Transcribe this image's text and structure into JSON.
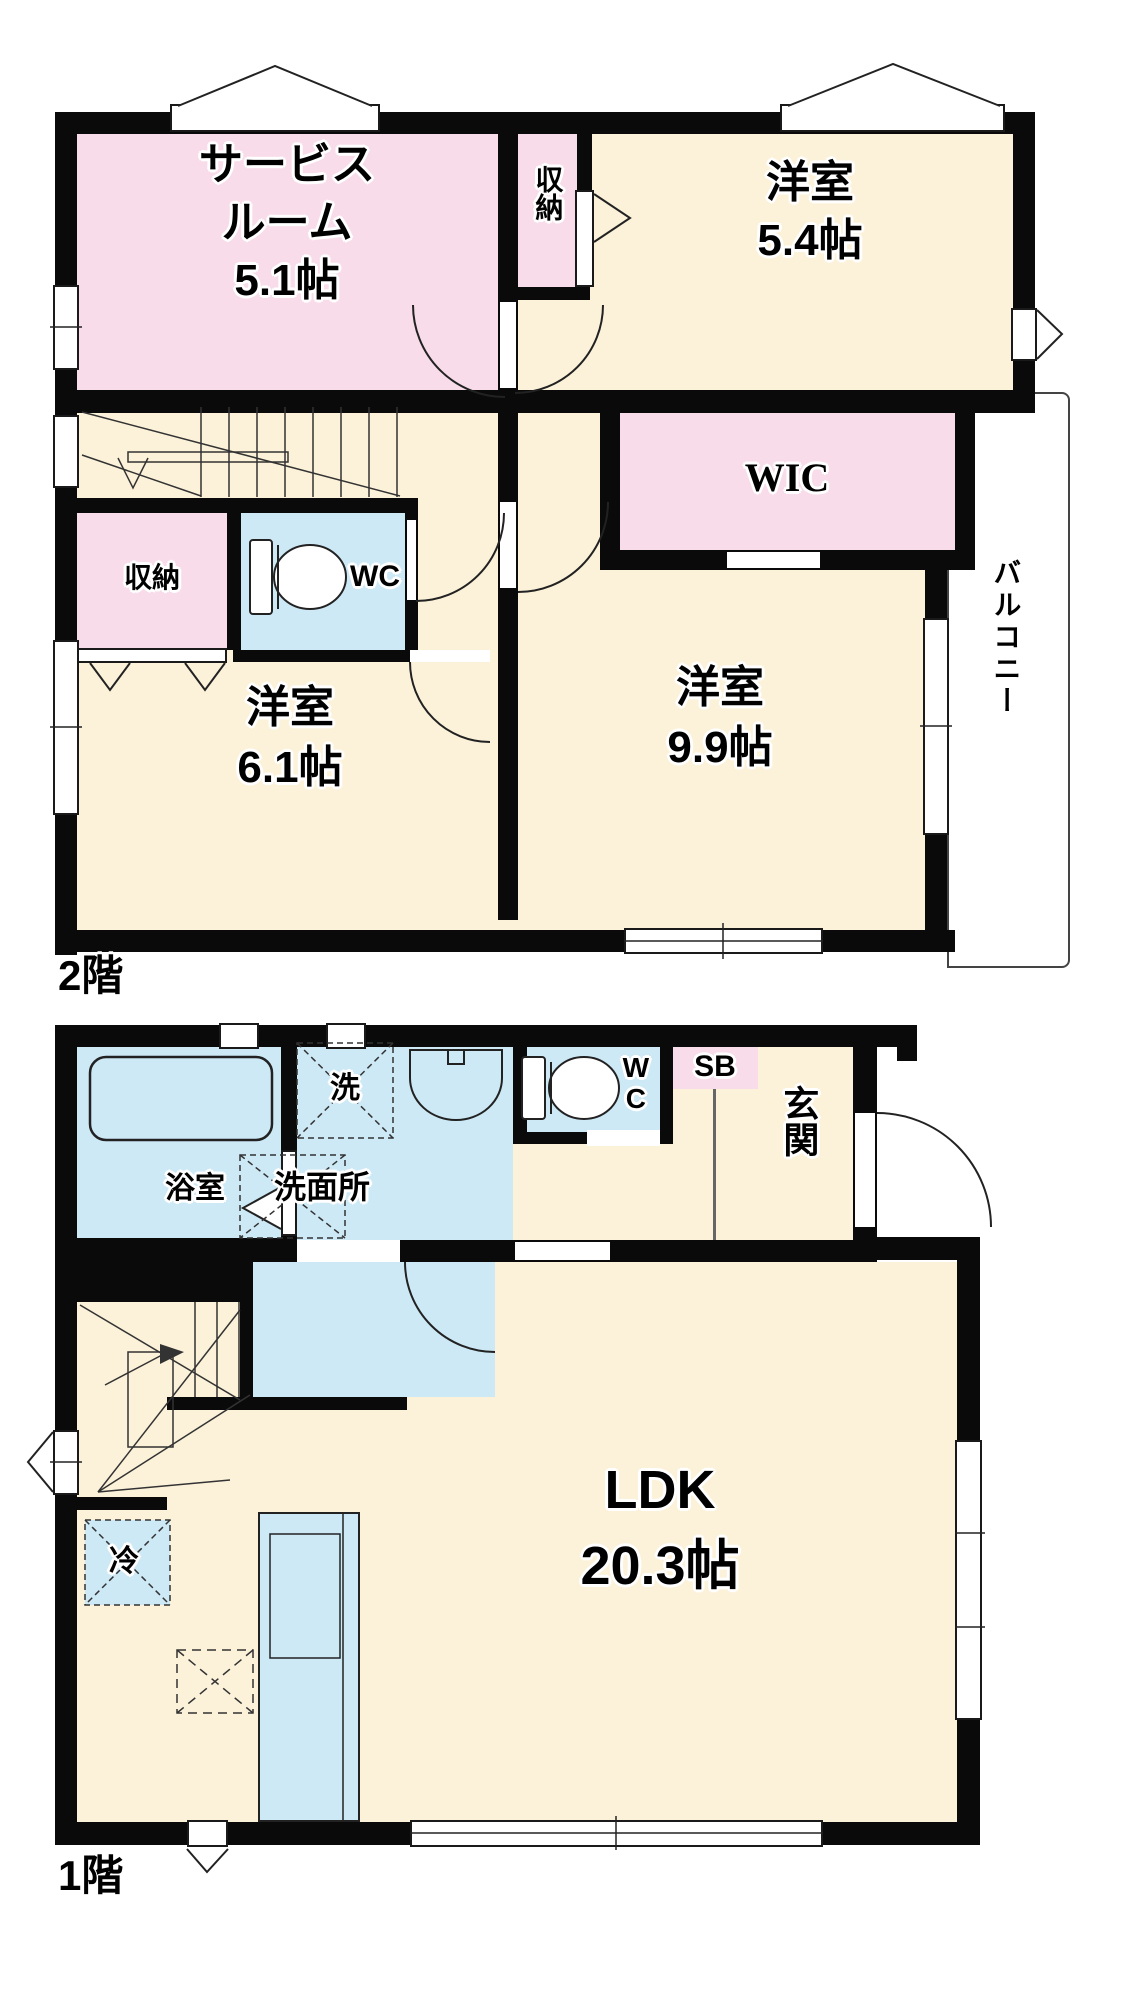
{
  "title": "2階建て間取り図",
  "colors": {
    "wall": "#0a0a0a",
    "room_pink": "#f8dce9",
    "room_cream": "#fcf2da",
    "room_blue": "#cde9f6",
    "line": "#2a2a2a",
    "background": "#ffffff"
  },
  "floor2": {
    "label": "2階",
    "rooms": {
      "service_room": {
        "line1": "サービス",
        "line2": "ルーム",
        "size": "5.1帖"
      },
      "closet_top": "収納",
      "western_54": {
        "name": "洋室",
        "size": "5.4帖"
      },
      "wic": "WIC",
      "closet": "収納",
      "wc": "WC",
      "western_61": {
        "name": "洋室",
        "size": "6.1帖"
      },
      "western_99": {
        "name": "洋室",
        "size": "9.9帖"
      },
      "balcony": "バルコニー"
    }
  },
  "floor1": {
    "label": "1階",
    "rooms": {
      "bathroom": "浴室",
      "washer": "洗",
      "washroom": "洗面所",
      "wc": "WC",
      "shoebox": "SB",
      "entrance": "玄関",
      "ldk": {
        "name": "LDK",
        "size": "20.3帖"
      },
      "fridge": "冷"
    }
  }
}
